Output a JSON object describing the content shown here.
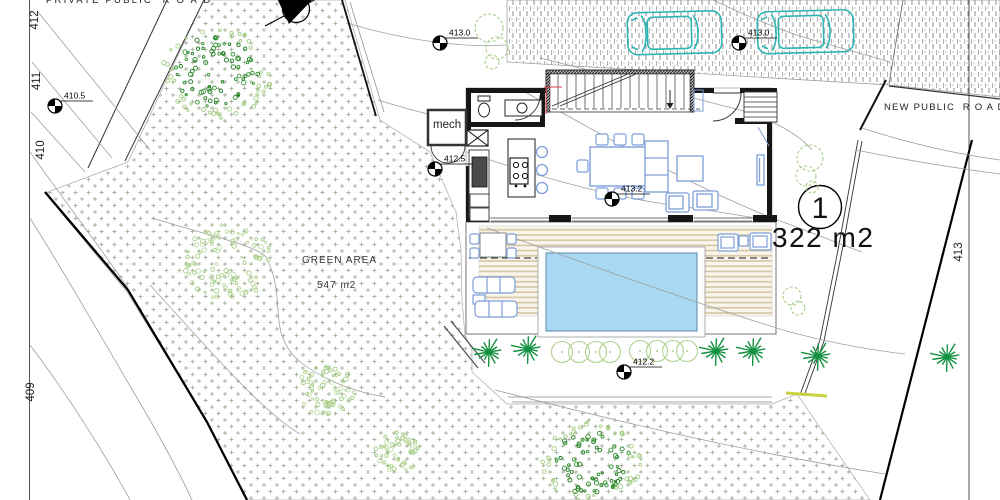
{
  "drawing": {
    "roads": {
      "private_road_label": "PRIVATE PUBLIC  R O A D",
      "new_road_label": "NEW PUBLIC  R O A D"
    },
    "green_area": {
      "title": "GREEN AREA",
      "area": "547 m2"
    },
    "plot": {
      "number": "1",
      "area_label": "322 m2"
    },
    "building": {
      "mech_label": "mech"
    },
    "spot_elevations": [
      {
        "label": "410.5",
        "x": 55,
        "y": 106
      },
      {
        "label": "413.0",
        "x": 440,
        "y": 43
      },
      {
        "label": "413.0",
        "x": 739,
        "y": 43
      },
      {
        "label": "412.5",
        "x": 435,
        "y": 169
      },
      {
        "label": "413.2",
        "x": 612,
        "y": 199
      },
      {
        "label": "412.2",
        "x": 624,
        "y": 372
      }
    ],
    "contour_labels": [
      {
        "text": "412",
        "x": 38,
        "y": 20
      },
      {
        "text": "411",
        "x": 40,
        "y": 81
      },
      {
        "text": "410",
        "x": 44,
        "y": 150
      },
      {
        "text": "409",
        "x": 34,
        "y": 392
      },
      {
        "text": "413",
        "x": 962,
        "y": 252
      }
    ],
    "vegetation": {
      "dense_trees": [
        {
          "x": 217,
          "y": 72,
          "r": 52,
          "tone": "dark"
        },
        {
          "x": 592,
          "y": 462,
          "r": 47,
          "tone": "dark"
        },
        {
          "x": 228,
          "y": 262,
          "r": 42,
          "tone": "light"
        },
        {
          "x": 325,
          "y": 390,
          "r": 28,
          "tone": "light"
        },
        {
          "x": 398,
          "y": 452,
          "r": 22,
          "tone": "light"
        }
      ],
      "palms": [
        {
          "x": 489,
          "y": 352
        },
        {
          "x": 528,
          "y": 349
        },
        {
          "x": 716,
          "y": 351
        },
        {
          "x": 753,
          "y": 351
        },
        {
          "x": 818,
          "y": 356
        },
        {
          "x": 947,
          "y": 357
        }
      ],
      "bush_rows": [
        {
          "cx": [
            562,
            579,
            596,
            610
          ],
          "y": 352
        },
        {
          "cx": [
            640,
            657,
            673,
            687
          ],
          "y": 351
        }
      ],
      "outline_bushes": [
        {
          "x": 489,
          "y": 28,
          "r": 14
        },
        {
          "x": 497,
          "y": 48,
          "r": 11
        },
        {
          "x": 492,
          "y": 62,
          "r": 7
        },
        {
          "x": 810,
          "y": 158,
          "r": 13
        },
        {
          "x": 806,
          "y": 176,
          "r": 10
        },
        {
          "x": 812,
          "y": 187,
          "r": 6
        },
        {
          "x": 792,
          "y": 296,
          "r": 9
        },
        {
          "x": 798,
          "y": 308,
          "r": 7
        }
      ]
    },
    "colors": {
      "car": "#2cb5b2",
      "furniture": "#7d9ed9",
      "pool": "#a9d9f2",
      "deck_line": "#d5c5a5",
      "stipple": "#a9b49e",
      "palm": "#12913f",
      "tree_dark": "#1e7d1e",
      "tree_light": "#a4cd84",
      "contour": "#9f9f9f",
      "wall": "#161616",
      "accent_red": "#e04040",
      "survey_yellow": "#c9d23f"
    }
  }
}
